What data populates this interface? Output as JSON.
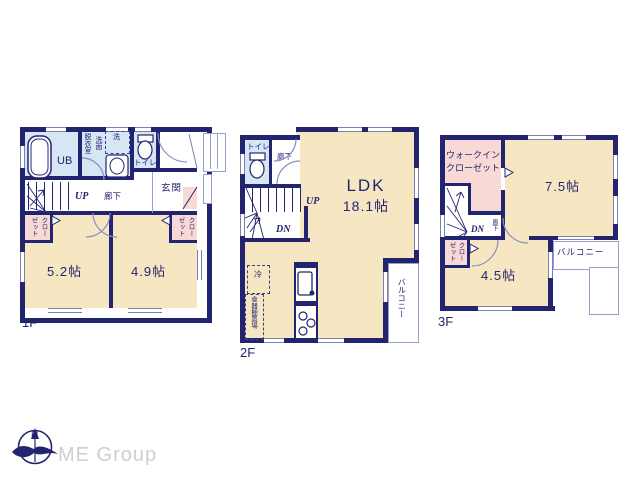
{
  "colors": {
    "wall": "#23246f",
    "room_fill": "#f6e7c2",
    "wet_fill": "#d6e6f4",
    "closet_fill": "#f8d9d6",
    "thin_line": "#9aa0c8",
    "brand_gray": "#cfcfcf"
  },
  "floors": [
    {
      "label": "1F",
      "rooms": {
        "ub": "UB",
        "dressing": "脱衣室",
        "washstand": "洗面",
        "laundry": "洗",
        "toilet": "トイレ",
        "entrance": "玄関",
        "hallway": "廊下",
        "up": "UP",
        "closet_left": "クローゼット",
        "closet_right": "クローゼット",
        "room_a": "5.2帖",
        "room_b": "4.9帖"
      }
    },
    {
      "label": "2F",
      "rooms": {
        "toilet": "トイレ",
        "hallway": "廊下",
        "up": "UP",
        "dn": "DN",
        "ldk": "LDK",
        "ldk_size": "18.1帖",
        "fridge": "冷",
        "cupboard": "食器棚置場",
        "balcony": "バルコニー"
      }
    },
    {
      "label": "3F",
      "rooms": {
        "wic_line1": "ウォークイン",
        "wic_line2": "クローゼット",
        "room_a": "7.5帖",
        "dn": "DN",
        "hallway": "廊下",
        "closet": "クローゼット",
        "room_b": "4.5帖",
        "balcony": "バルコニー"
      }
    }
  ],
  "footer": {
    "brand": "ME Group",
    "compass_north": "N"
  }
}
